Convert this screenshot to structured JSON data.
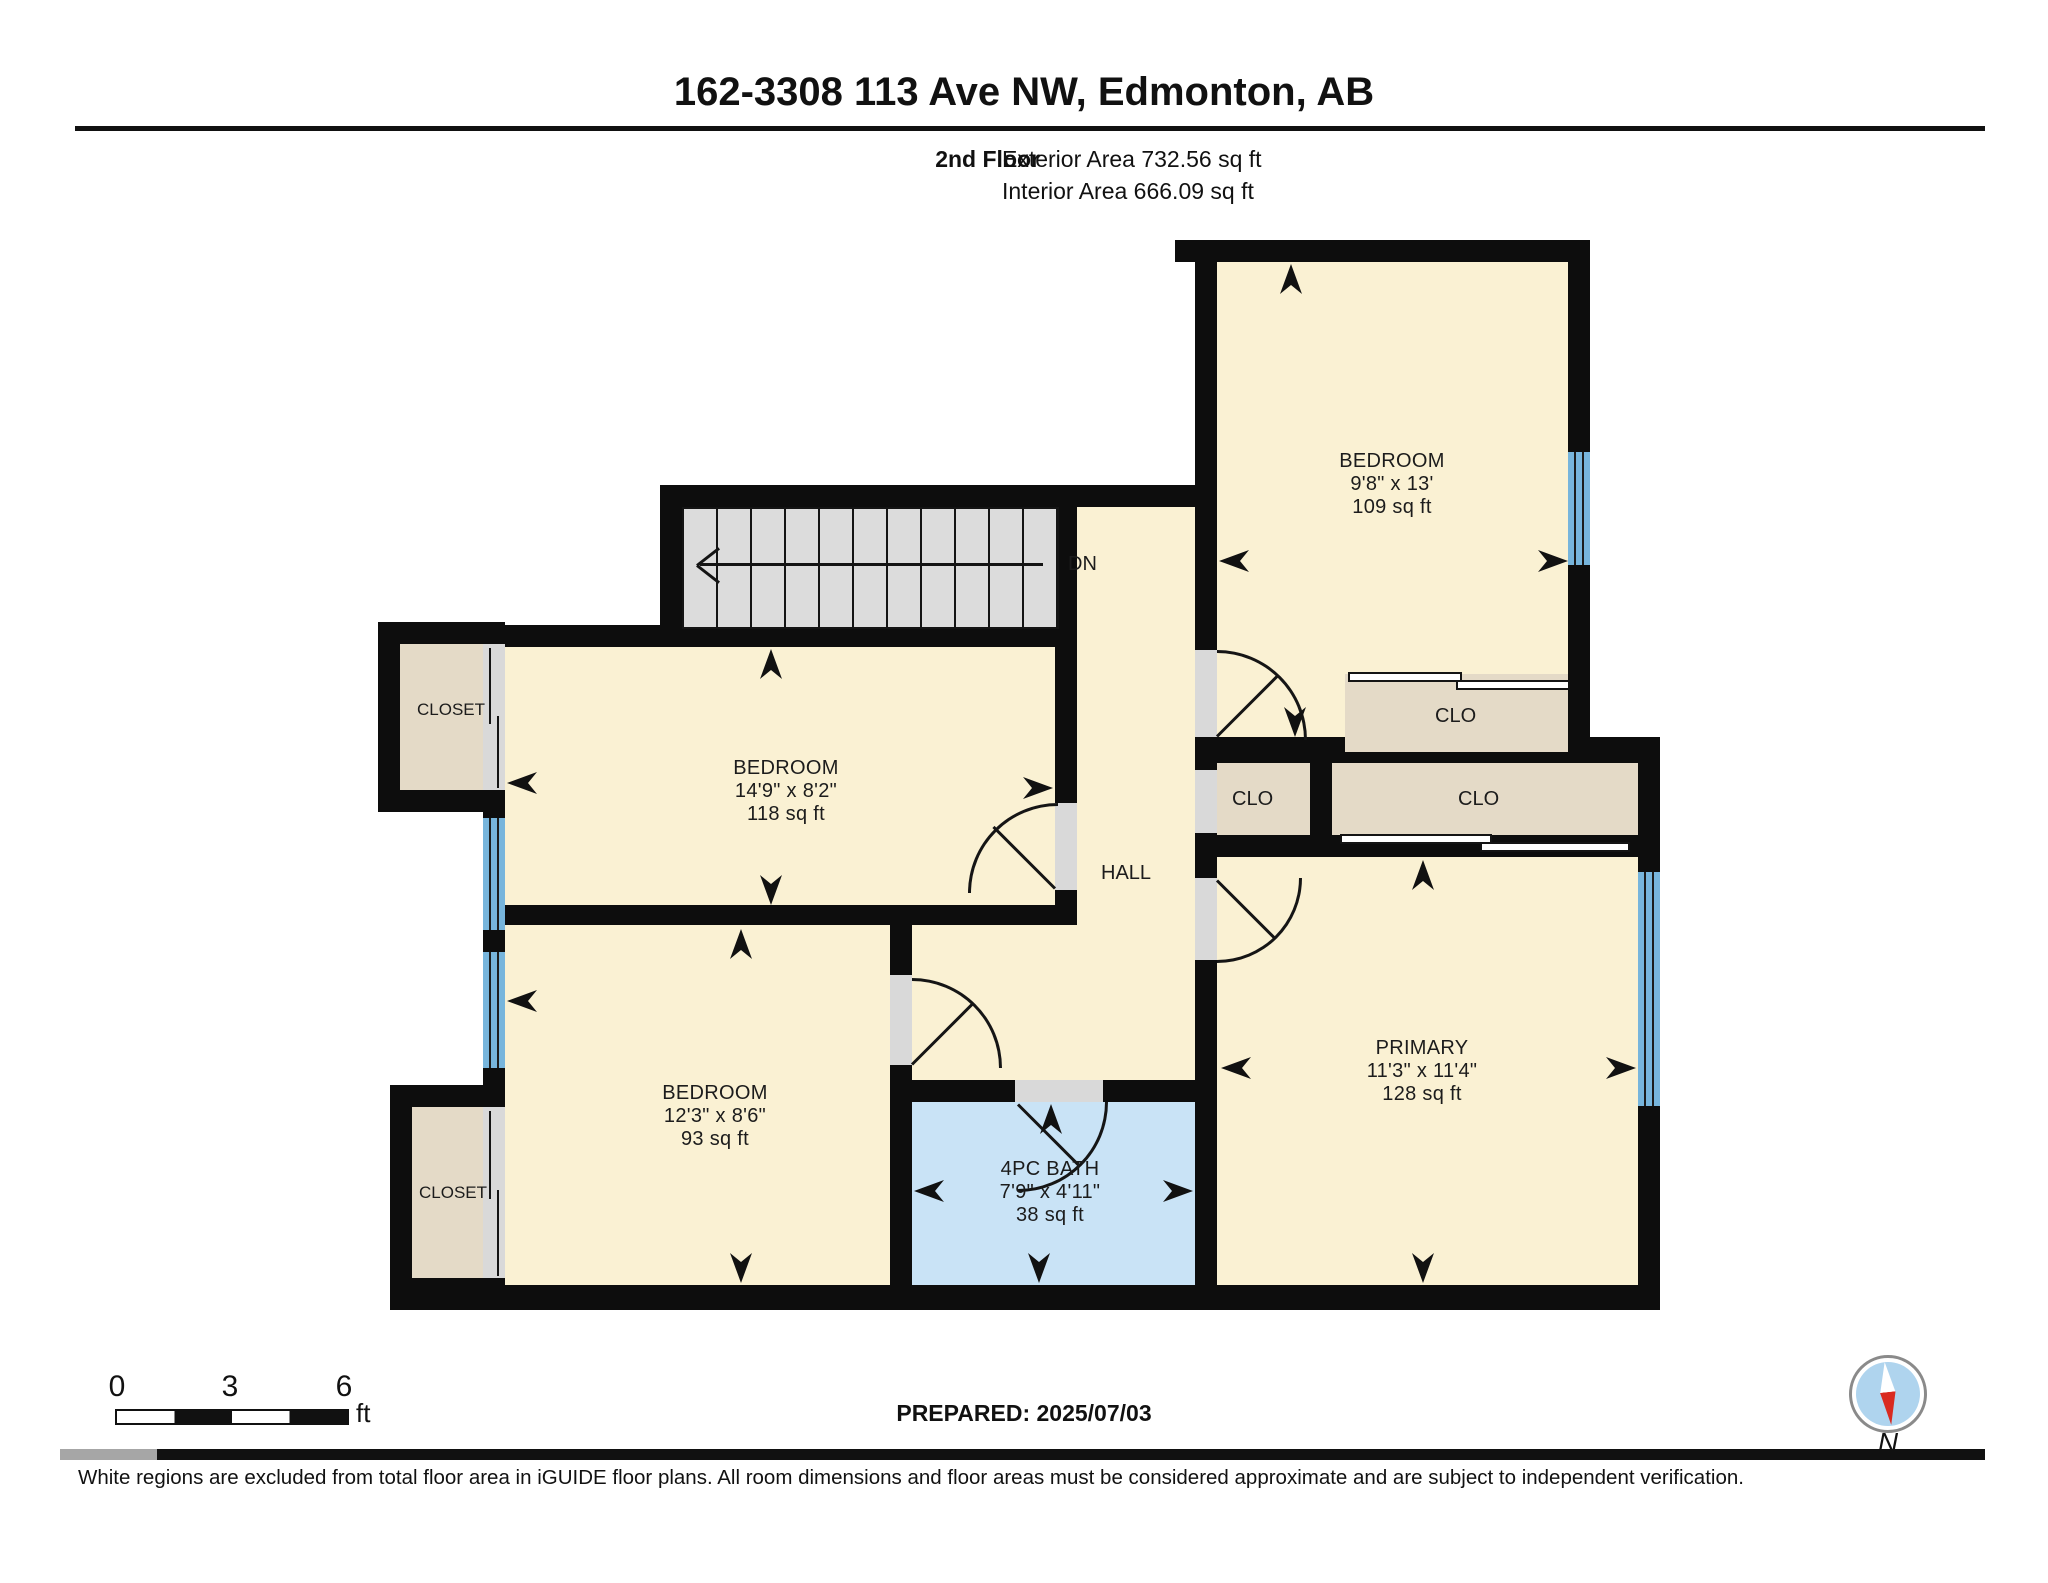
{
  "header": {
    "title": "162-3308 113 Ave NW, Edmonton, AB",
    "floor_label": "2nd Floor",
    "exterior_area": "Exterior Area 732.56 sq ft",
    "interior_area": "Interior Area 666.09 sq ft"
  },
  "rooms": {
    "bedroom_top": {
      "name": "BEDROOM",
      "dims": "9'8\" x 13'",
      "area": "109 sq ft"
    },
    "bedroom_mid": {
      "name": "BEDROOM",
      "dims": "14'9\" x 8'2\"",
      "area": "118 sq ft"
    },
    "bedroom_bot": {
      "name": "BEDROOM",
      "dims": "12'3\" x 8'6\"",
      "area": "93 sq ft"
    },
    "primary": {
      "name": "PRIMARY",
      "dims": "11'3\" x 11'4\"",
      "area": "128 sq ft"
    },
    "bath": {
      "name": "4PC BATH",
      "dims": "7'9\" x 4'11\"",
      "area": "38 sq ft"
    },
    "hall": {
      "name": "HALL"
    },
    "closet_left_top": {
      "name": "CLOSET"
    },
    "closet_left_bot": {
      "name": "CLOSET"
    },
    "clo_bedroom_top": {
      "name": "CLO"
    },
    "clo_hall": {
      "name": "CLO"
    },
    "clo_primary": {
      "name": "CLO"
    },
    "stairs": {
      "label": "DN"
    }
  },
  "scale_bar": {
    "t0": "0",
    "t1": "3",
    "t2": "6",
    "unit": "ft"
  },
  "prepared": "PREPARED: 2025/07/03",
  "compass": {
    "label": "N"
  },
  "footer": "White regions are excluded from total floor area in iGUIDE floor plans. All room dimensions and floor areas must be considered approximate and are subject to independent verification.",
  "colors": {
    "room_fill": "#FAF1D3",
    "closet_fill": "#E4DAC7",
    "bath_fill": "#C9E3F6",
    "window_blue": "#77B5DC",
    "stair_gray": "#DCDCDC",
    "opening_gray": "#D9D9D9",
    "wall_black": "#0D0D0D",
    "compass_blue": "#AFD4EE",
    "compass_red": "#D92A20"
  }
}
